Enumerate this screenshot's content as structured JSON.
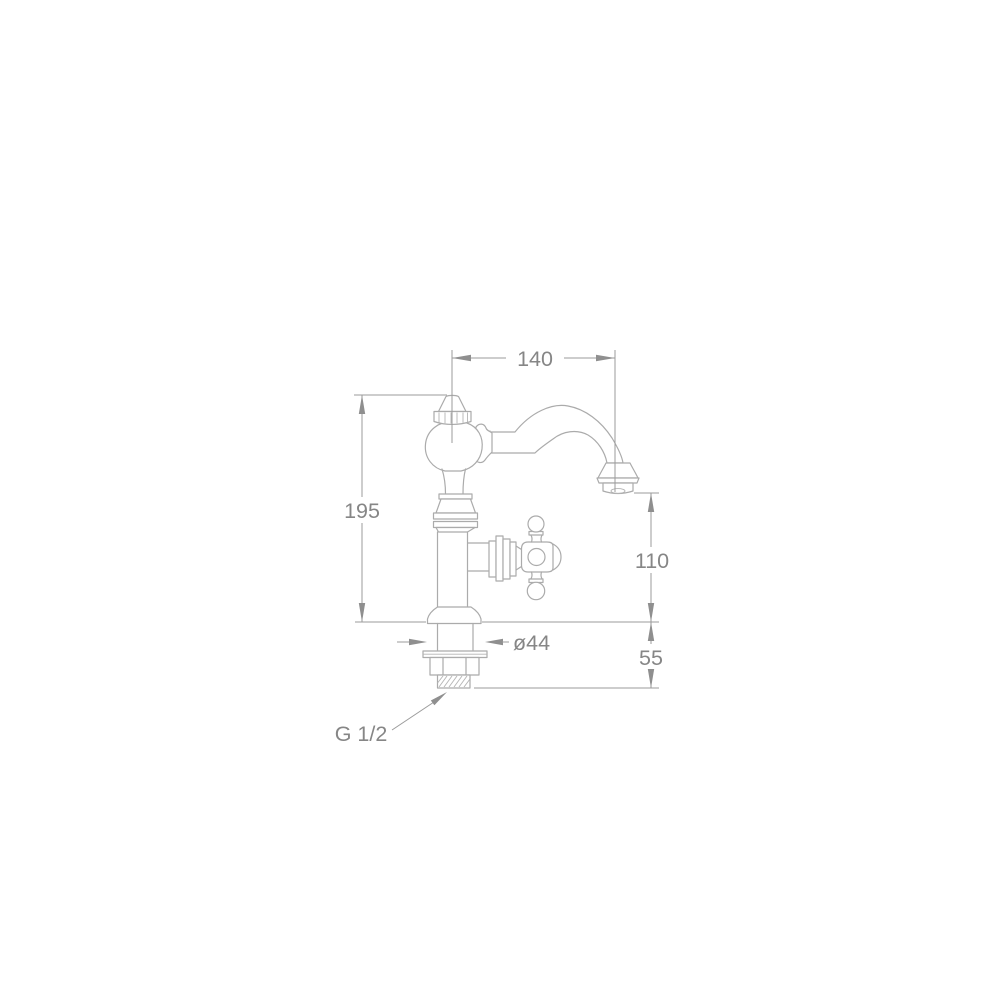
{
  "page": {
    "background_color": "#ffffff"
  },
  "drawing": {
    "type": "technical-dimension-drawing",
    "subject": "classic-basin-pillar-tap",
    "stroke_color": "#ababab",
    "dimension_line_color": "#9b9b9b",
    "text_color": "#868686",
    "labels": {
      "spout_reach": "140",
      "overall_height": "195",
      "outlet_height": "110",
      "shank_length": "55",
      "base_diameter": "ø44",
      "thread_size": "G 1/2"
    }
  }
}
